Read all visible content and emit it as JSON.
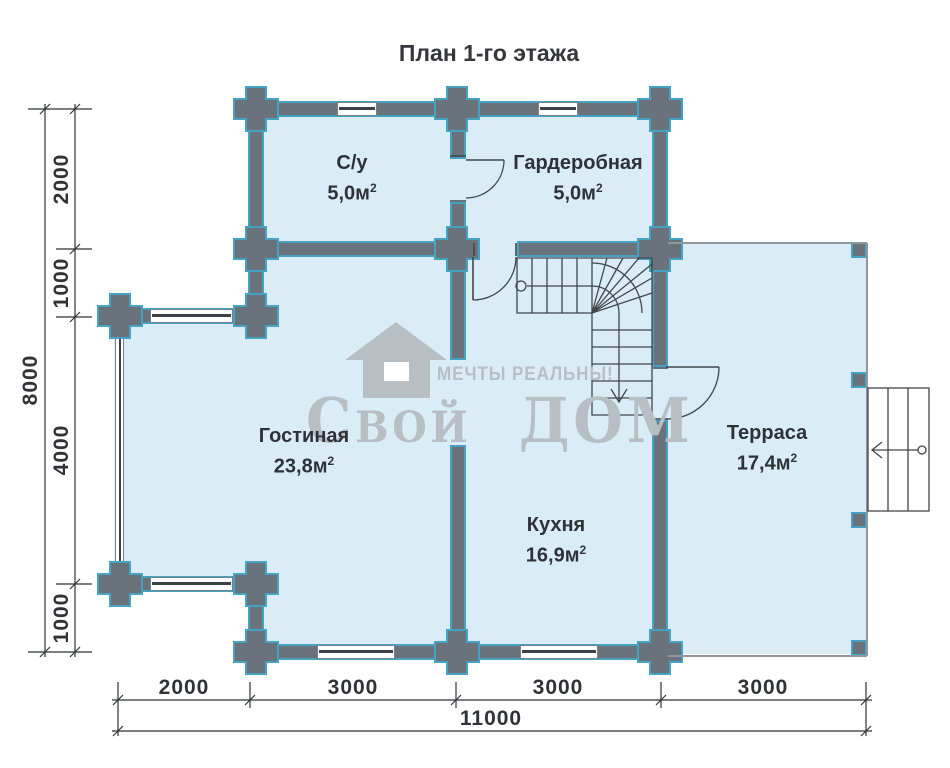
{
  "title": "План 1-го этажа",
  "rooms": {
    "bathroom": {
      "name": "С/у",
      "area": "5,0м"
    },
    "wardrobe": {
      "name": "Гардеробная",
      "area": "5,0м"
    },
    "living": {
      "name": "Гостиная",
      "area": "23,8м"
    },
    "kitchen": {
      "name": "Кухня",
      "area": "16,9м"
    },
    "terrace": {
      "name": "Терраса",
      "area": "17,4м"
    }
  },
  "sup": "2",
  "dimensions": {
    "left": {
      "total": "8000",
      "segments": [
        "2000",
        "1000",
        "4000",
        "1000"
      ]
    },
    "bottom": {
      "total": "11000",
      "segments": [
        "2000",
        "3000",
        "3000",
        "3000"
      ]
    }
  },
  "watermark": {
    "slogan": "МЕЧТЫ РЕАЛЬНЫ!",
    "brand": "Свой ДОМ"
  },
  "colors": {
    "wall": "#6a737b",
    "outline": "#45a3c2",
    "room_fill": "#daedf7",
    "line": "#41464c",
    "dim": "#2f3338",
    "text": "#2e3238",
    "watermark": "#b7bec4",
    "terrace_line": "#8f979d"
  }
}
